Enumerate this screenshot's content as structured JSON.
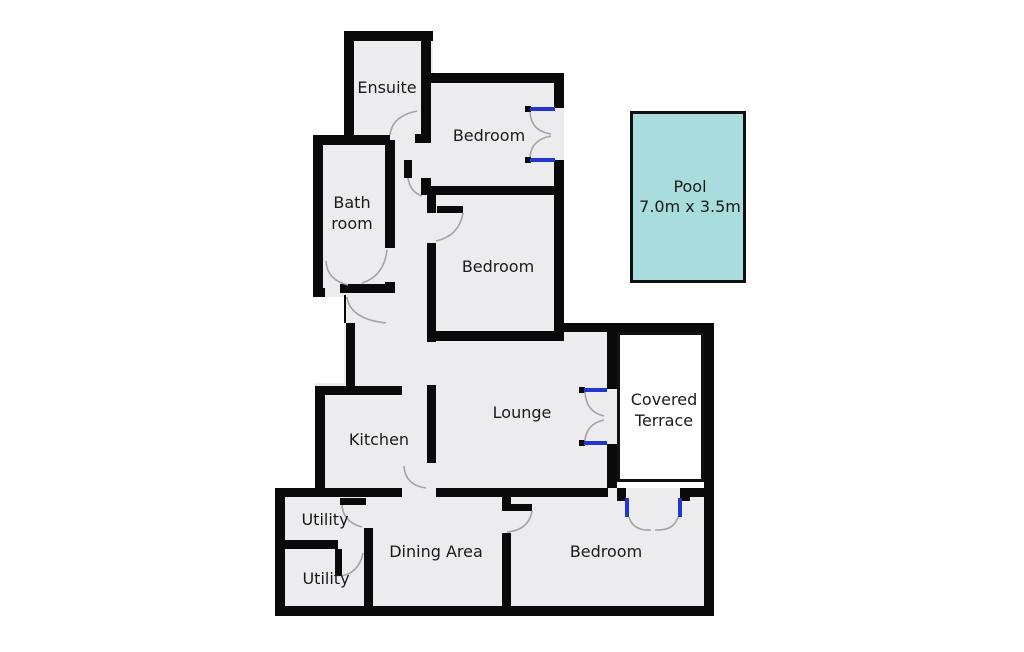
{
  "plan": {
    "rooms": {
      "ensuite": {
        "label": "Ensuite"
      },
      "bedroom_top": {
        "label": "Bedroom"
      },
      "bathroom": {
        "label_line1": "Bath",
        "label_line2": "room"
      },
      "bedroom_middle": {
        "label": "Bedroom"
      },
      "kitchen": {
        "label": "Kitchen"
      },
      "lounge": {
        "label": "Lounge"
      },
      "covered_terrace": {
        "label_line1": "Covered",
        "label_line2": "Terrace"
      },
      "utility_upper": {
        "label": "Utility"
      },
      "utility_lower": {
        "label": "Utility"
      },
      "dining_area": {
        "label": "Dining Area"
      },
      "bedroom_bottom": {
        "label": "Bedroom"
      }
    },
    "pool": {
      "label": "Pool",
      "dimensions": "7.0m x 3.5m"
    }
  },
  "colors": {
    "wall_color": "#0a0a0a",
    "room_fill": "#ececee",
    "pool_fill": "#a9dcdd",
    "terrace_fill": "#ffffff",
    "window_color": "#2336cf",
    "arc_color": "#a3a3a3",
    "text_color": "#1a1a1a"
  }
}
